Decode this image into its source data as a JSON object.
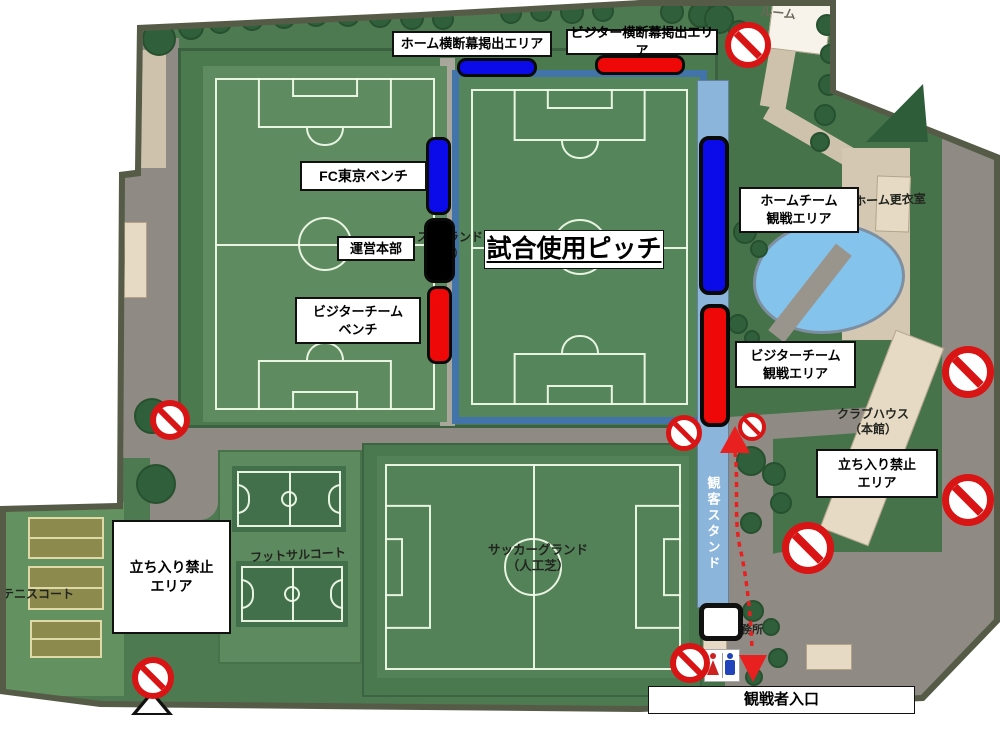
{
  "icons": {
    "no_entry": "no-entry-icon",
    "toilet": "toilet-icon",
    "survey_triangle": "triangle-marker-icon",
    "route_arrow": "route-arrow-icon",
    "tree": "tree-icon"
  },
  "colors": {
    "home_blue": "#0b0bea",
    "visitor_red": "#ee0808",
    "operations_black": "#000000",
    "prohibition_red": "#d81414",
    "match_pitch_frame_blue": "#4273a9",
    "stand_blue": "#8cb5dc",
    "pond_blue": "#84c3ec",
    "route_red": "#e82020"
  },
  "area_labels": {
    "home_banner": "ホーム横断幕掲出エリア",
    "visitor_banner": "ビジター横断幕掲出エリア",
    "fc_tokyo_bench": "FC東京ベンチ",
    "operations_hq": "運営本部",
    "visitor_bench": "ビジターチーム\nベンチ",
    "match_pitch": "試合使用ピッチ",
    "home_spectator_area": "ホームチーム\n観戦エリア",
    "visitor_spectator_area": "ビジターチーム\n観戦エリア",
    "no_entry_area_right": "立ち入り禁止\nエリア",
    "no_entry_area_left": "立ち入り禁止\nエリア",
    "spectator_entrance": "観戦者入口"
  },
  "map_texts": {
    "soccer_ground": "サッカーグランド\n（人工芝）",
    "futsal_court": "フットサルコート",
    "tennis_court": "テニスコート",
    "clubhouse": "クラブハウス\n（本館）",
    "home_locker_room": "ホーム更衣室",
    "office_partial": "務所",
    "room_partial": "ルーム",
    "spectator_stand": "観客スタンド",
    "obscured_label_line1a": "ス",
    "obscured_label_line1b": "ランド",
    "obscured_label_line2a": "（",
    "obscured_label_line2b": "芝）"
  }
}
